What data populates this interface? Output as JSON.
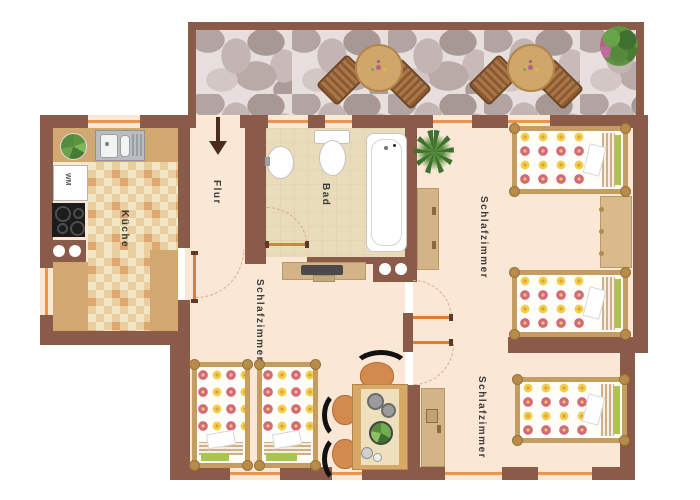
{
  "floorplan": {
    "colors": {
      "wall": "#8a5b48",
      "floor": "#fbe7d6",
      "window_accent": "#ec9449",
      "bath_tile": "#e9dcba",
      "kitchen_counter": "#d1a870",
      "terrace_stone_base": "#e6dfdd",
      "bed_frame": "#c69d61",
      "flower_pink": "#d2697f",
      "flower_yellow": "#efcf4b"
    },
    "rooms": {
      "kitchen": {
        "label": "Küche"
      },
      "hallway": {
        "label": "Flur"
      },
      "bathroom": {
        "label": "Bad"
      },
      "bedroom_top_right": {
        "label": "Schlafzimmer"
      },
      "bedroom_middle": {
        "label": "Schlafzimmer"
      },
      "bedroom_bottom_right": {
        "label": "Schlafzimmer"
      }
    },
    "appliances": {
      "washing_machine_label": "WM"
    }
  }
}
